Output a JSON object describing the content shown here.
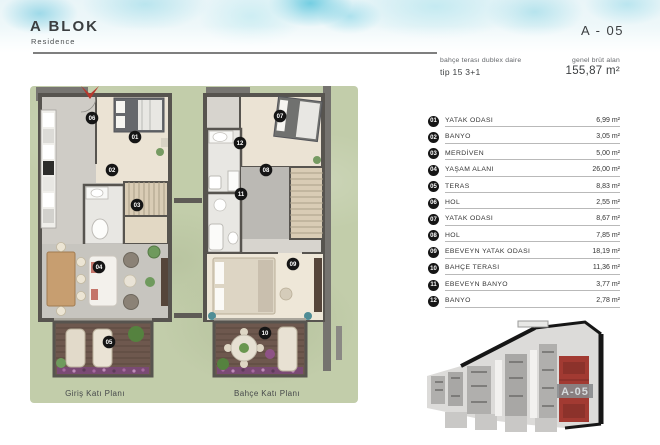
{
  "header": {
    "title": "A BLOK",
    "subtitle": "Residence",
    "unit_code": "A - 05"
  },
  "info": {
    "type_label": "bahçe terası dublex daire",
    "type_value": "tip 15 3+1",
    "area_label": "genel brüt alan",
    "area_value": "155,87 m²"
  },
  "rooms": [
    {
      "no": "01",
      "name": "YATAK ODASI",
      "area": "6,99 m²"
    },
    {
      "no": "02",
      "name": "BANYO",
      "area": "3,05 m²"
    },
    {
      "no": "03",
      "name": "MERDİVEN",
      "area": "5,00 m²"
    },
    {
      "no": "04",
      "name": "YAŞAM ALANI",
      "area": "26,00 m²"
    },
    {
      "no": "05",
      "name": "TERAS",
      "area": "8,83 m²"
    },
    {
      "no": "06",
      "name": "HOL",
      "area": "2,55 m²"
    },
    {
      "no": "07",
      "name": "YATAK ODASI",
      "area": "8,67 m²"
    },
    {
      "no": "08",
      "name": "HOL",
      "area": "7,85 m²"
    },
    {
      "no": "09",
      "name": "EBEVEYN YATAK ODASI",
      "area": "18,19 m²"
    },
    {
      "no": "10",
      "name": "BAHÇE TERASI",
      "area": "11,36 m²"
    },
    {
      "no": "11",
      "name": "EBEVEYN BANYO",
      "area": "3,77 m²"
    },
    {
      "no": "12",
      "name": "BANYO",
      "area": "2,78 m²"
    }
  ],
  "plans": {
    "captions": {
      "left": "Giriş Katı Planı",
      "right": "Bahçe Katı Planı"
    },
    "markers": [
      "01",
      "02",
      "03",
      "04",
      "05",
      "06",
      "07",
      "08",
      "09",
      "10",
      "11",
      "12"
    ]
  },
  "keyplan": {
    "label": "A-05"
  },
  "colors": {
    "accent_red": "#a23a32",
    "watercolor_cyan": "#7fd0e2",
    "grass": "#c2cdaa",
    "wall": "#57544f",
    "deck": "#6e584e",
    "flower_strip": "#7a4a74"
  }
}
